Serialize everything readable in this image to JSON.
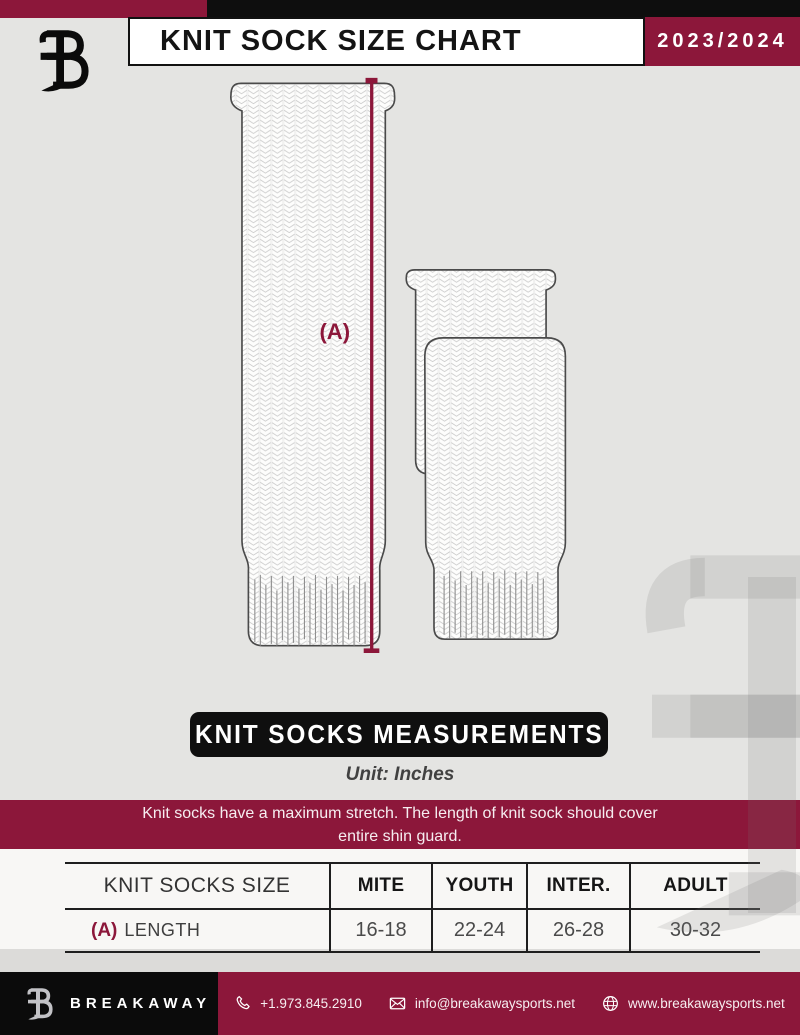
{
  "header": {
    "title": "KNIT SOCK SIZE CHART",
    "season": "2023/2024"
  },
  "diagram": {
    "measurement_label": "(A)",
    "banner": "KNIT SOCKS MEASUREMENTS",
    "unit_label": "Unit: Inches"
  },
  "note": {
    "line1": "Knit socks have a maximum stretch. The length of knit sock should cover",
    "line2": "entire shin guard."
  },
  "size_table": {
    "size_label": "KNIT SOCKS SIZE",
    "columns": [
      "MITE",
      "YOUTH",
      "INTER.",
      "ADULT"
    ],
    "row": {
      "key": "(A)",
      "label": "LENGTH",
      "values": [
        "16-18",
        "22-24",
        "26-28",
        "30-32"
      ]
    }
  },
  "footer": {
    "brand": "BREAKAWAY",
    "phone": "+1.973.845.2910",
    "email": "info@breakawaysports.net",
    "website": "www.breakawaysports.net"
  },
  "colors": {
    "maroon": "#8C173A",
    "black": "#0E0E0E",
    "background": "#E4E4E2",
    "knit_stitch": "#C9C9C9",
    "sock_outline": "#4A4A4A"
  }
}
